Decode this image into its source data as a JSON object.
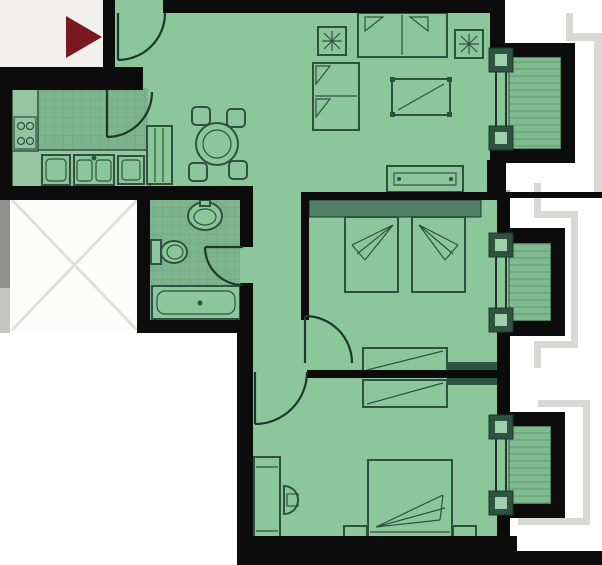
{
  "meta": {
    "title": "Apartment floor plan",
    "type": "architectural-floor-plan"
  },
  "colors": {
    "bg": "#ffffff",
    "wall": "#0b0c0b",
    "floor": "#8cc79c",
    "floor_tile": "#7db48d",
    "tile_line": "#6da57e",
    "counter": "#94c4a0",
    "line": "#2f5140",
    "line_dark": "#1d382a",
    "balcony_base": "#7fbb8e",
    "balcony_stripe": "#70ab80",
    "band": "#4f8066",
    "band_dark": "#2f5340",
    "post_inner": "#9ed0ab",
    "void_bg": "#fcfcfb",
    "void_x": "#e0dfdd",
    "entry_bg": "#f1f0ee",
    "arrow": "#7a1a20",
    "outline_gray": "#d8d8d6",
    "strip_dark": "#8e908e",
    "strip_light": "#c4c6c4"
  },
  "plan": {
    "rooms": [
      {
        "id": "entry",
        "label": "entry"
      },
      {
        "id": "kitchen",
        "label": "kitchen"
      },
      {
        "id": "living-dining-room",
        "label": "living-dining-room"
      },
      {
        "id": "bathroom",
        "label": "bathroom"
      },
      {
        "id": "hallway",
        "label": "hallway"
      },
      {
        "id": "bedroom-1",
        "label": "bedroom-1"
      },
      {
        "id": "bedroom-2",
        "label": "bedroom-2"
      },
      {
        "id": "void-shaft",
        "label": "void-shaft"
      },
      {
        "id": "balcony-1",
        "label": "balcony-1"
      },
      {
        "id": "balcony-2",
        "label": "balcony-2"
      },
      {
        "id": "balcony-3",
        "label": "balcony-3"
      }
    ],
    "furniture": {
      "kitchen": [
        "counter",
        "stove",
        "washing-machine",
        "double-sink",
        "dishwasher"
      ],
      "living": [
        "entrance-door",
        "shoe-cabinet",
        "dining-table",
        "dining-chairs",
        "sofa-top",
        "sofa-left",
        "plant-table-left",
        "plant-table-right",
        "coffee-table",
        "tv-console"
      ],
      "bathroom": [
        "washbasin",
        "toilet",
        "bathtub",
        "bathroom-door"
      ],
      "bedroom1": [
        "headboard-shelf",
        "single-bed-left",
        "single-bed-right",
        "wardrobe",
        "door"
      ],
      "bedroom2": [
        "desk",
        "desk-chair",
        "double-bed",
        "nightstand-left",
        "nightstand-right",
        "wardrobe",
        "door"
      ]
    },
    "indicators": [
      "entrance-direction-arrow"
    ]
  }
}
